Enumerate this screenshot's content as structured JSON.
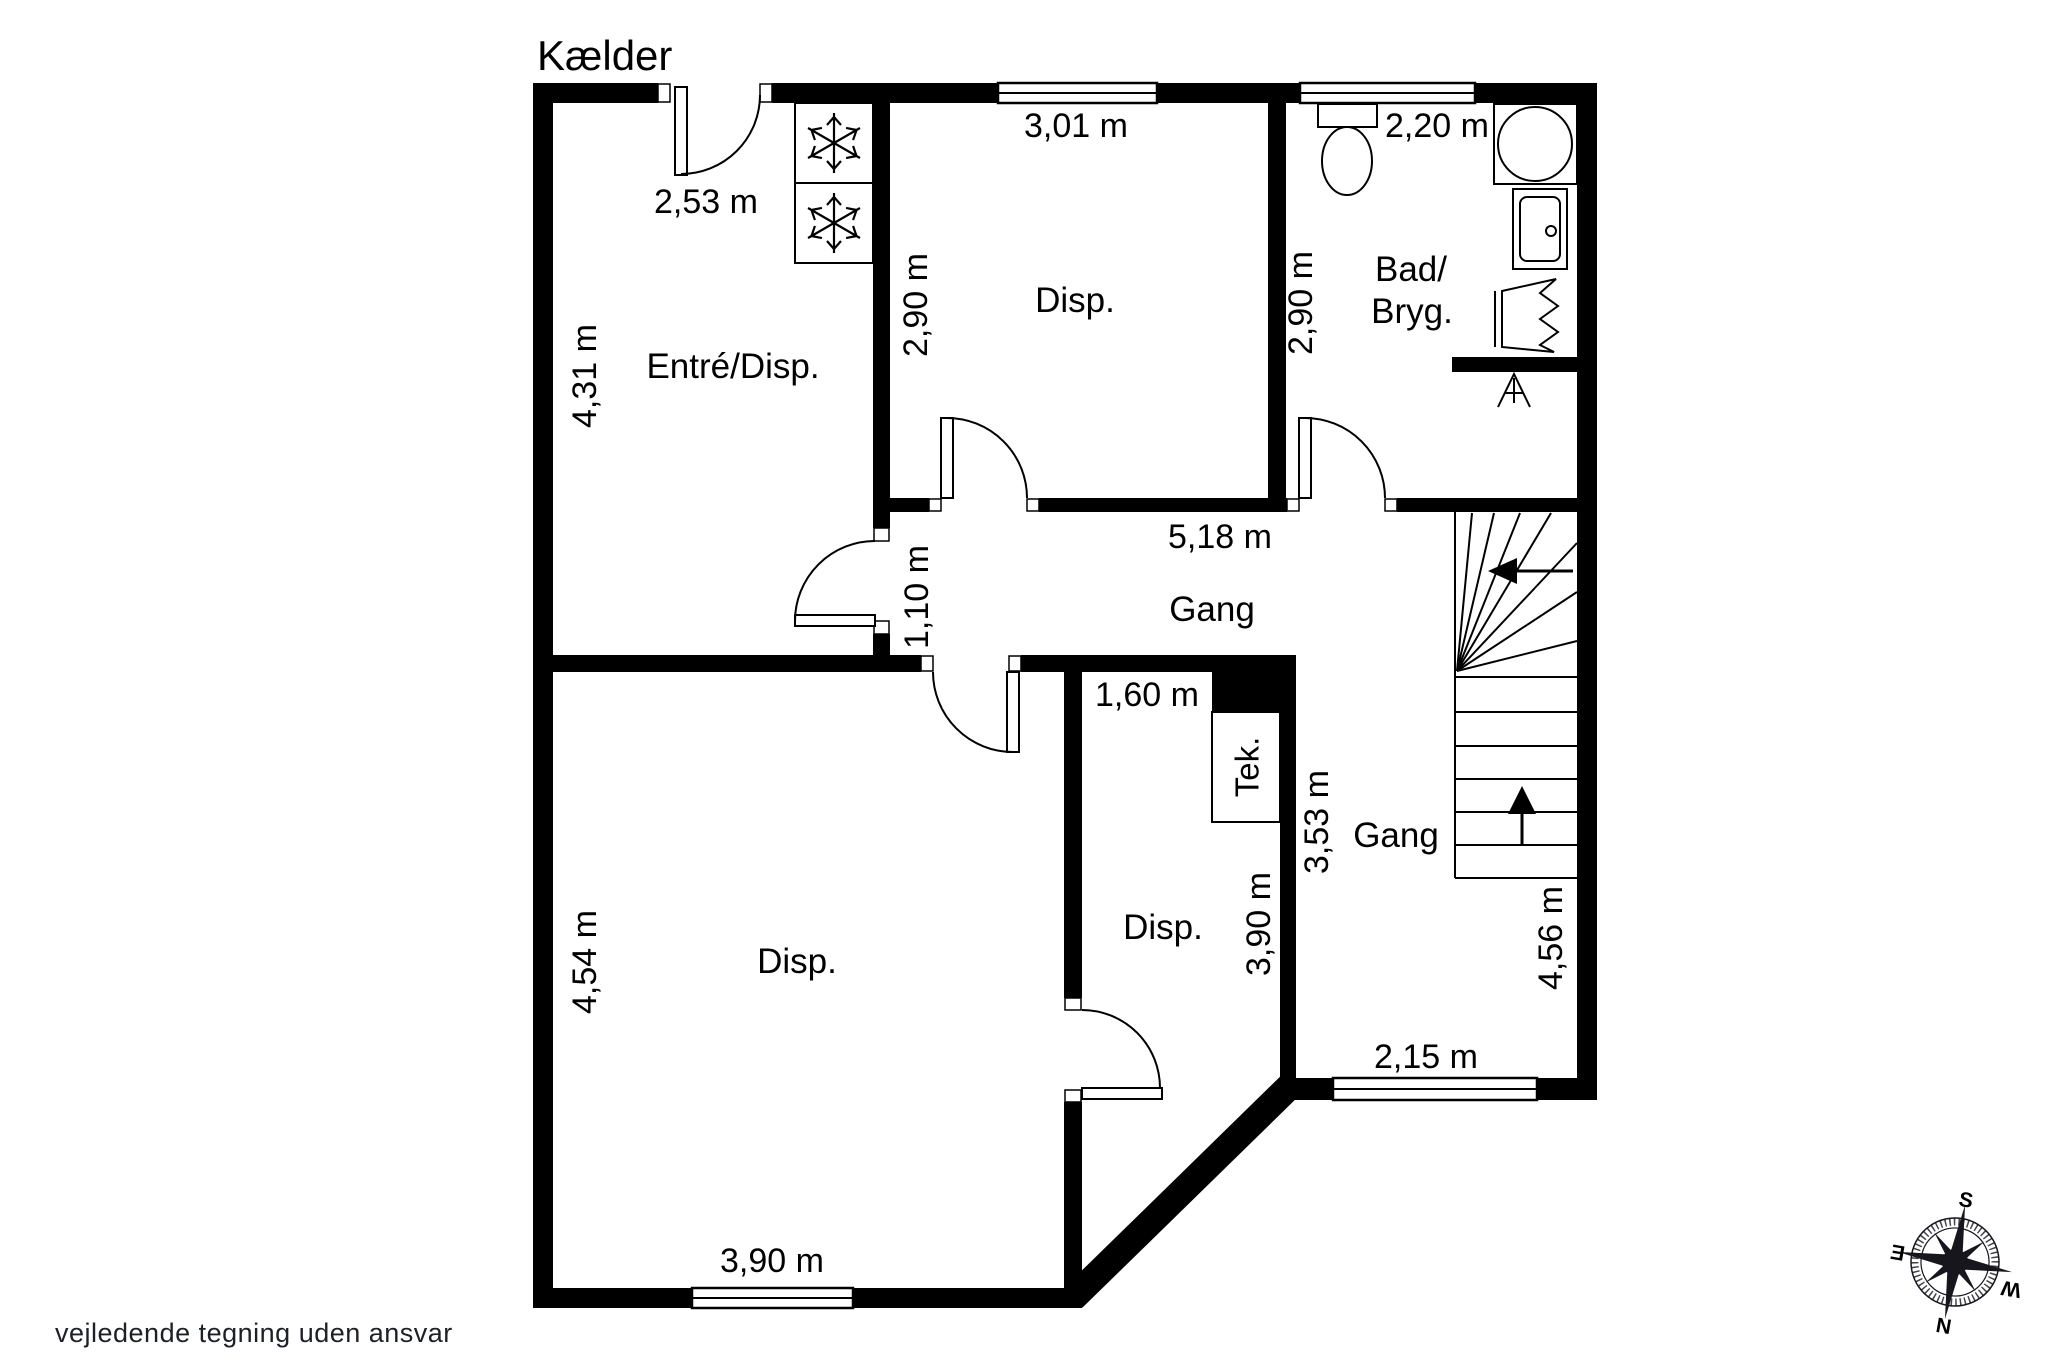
{
  "page": {
    "title": "Kælder",
    "disclaimer": "vejledende tegning uden ansvar"
  },
  "labels": {
    "room_entre": "Entré/Disp.",
    "room_disp_top": "Disp.",
    "room_bad_1": "Bad/",
    "room_bad_2": "Bryg.",
    "room_gang_upper": "Gang",
    "room_gang_lower": "Gang",
    "room_disp_big": "Disp.",
    "room_disp_mid": "Disp.",
    "room_tek": "Tek."
  },
  "dims": {
    "entre_w": "2,53 m",
    "entre_h": "4,31 m",
    "disp_top_w": "3,01 m",
    "disp_top_h": "2,90 m",
    "bad_w": "2,20 m",
    "bad_h": "2,90 m",
    "gang_len": "5,18 m",
    "gang_w": "1,10 m",
    "mid_top_w": "1,60 m",
    "gang_lower_h": "3,53 m",
    "mid_h": "3,90 m",
    "big_h": "4,54 m",
    "big_w": "3,90 m",
    "gang_lower_w": "2,15 m",
    "stair_h": "4,56 m"
  },
  "compass": {
    "top": "S",
    "left": "E",
    "right": "W",
    "bottom": "N"
  },
  "colors": {
    "wall": "#000000",
    "background": "#ffffff",
    "text": "#000000",
    "disclaimer_text": "#1d2026"
  }
}
